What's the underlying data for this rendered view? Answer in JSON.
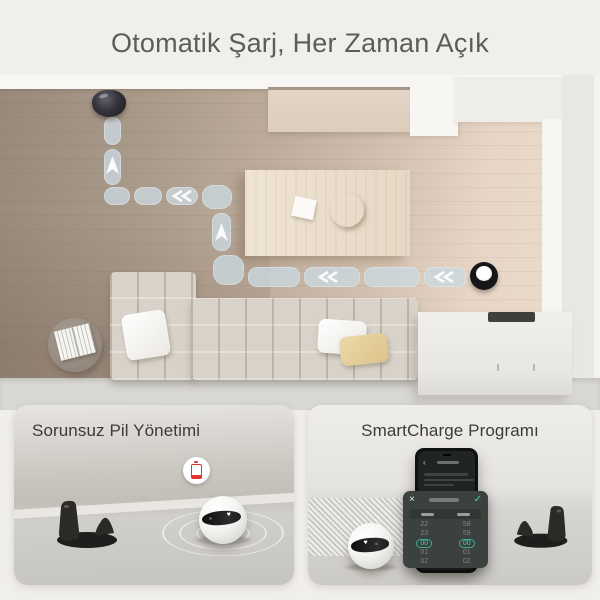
{
  "title": "Otomatik Şarj, Her Zaman Açık",
  "icons": {
    "heart": "♥",
    "back": "‹",
    "close": "×",
    "confirm": "✓"
  },
  "colors": {
    "background": "#f1efeb",
    "heading_text": "#5d5c5a",
    "path_pill": "#cbd8e0",
    "accent_teal": "#3fd0b2",
    "battery_red": "#e0342f"
  },
  "cards": {
    "battery": {
      "title": "Sorunsuz Pil Yönetimi"
    },
    "smartcharge": {
      "title": "SmartCharge Programı",
      "phone": {
        "modal": {
          "picker": {
            "hours": [
              "22",
              "23",
              "00",
              "01",
              "02"
            ],
            "minutes": [
              "58",
              "59",
              "00",
              "01",
              "02"
            ],
            "selected_hour": "00",
            "selected_minute": "00"
          }
        }
      }
    }
  }
}
